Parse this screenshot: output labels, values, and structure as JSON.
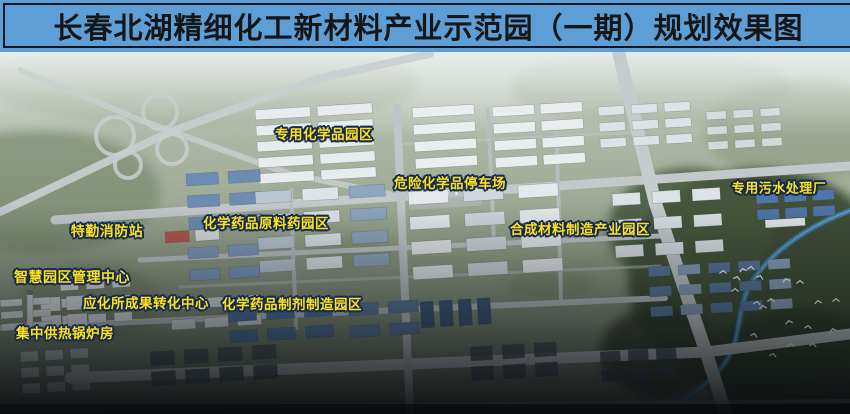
{
  "title": "长春北湖精细化工新材料产业示范园（一期）规划效果图",
  "map": {
    "labels": [
      {
        "id": "special-chemicals-park",
        "text": "专用化学品园区"
      },
      {
        "id": "hazardous-chemicals-parking",
        "text": "危险化学品停车场"
      },
      {
        "id": "dedicated-sewage-plant",
        "text": "专用污水处理厂"
      },
      {
        "id": "api-pharma-park",
        "text": "化学药品原料药园区"
      },
      {
        "id": "special-fire-station",
        "text": "特勤消防站"
      },
      {
        "id": "synthetic-materials-park",
        "text": "合成材料制造产业园区"
      },
      {
        "id": "smart-park-management-center",
        "text": "智慧园区管理中心"
      },
      {
        "id": "ciac-achievement-transfer-center",
        "text": "应化所成果转化中心"
      },
      {
        "id": "pharma-preparation-park",
        "text": "化学药品制剂制造园区"
      },
      {
        "id": "central-heating-boiler-house",
        "text": "集中供热锅炉房"
      }
    ],
    "colors": {
      "title_bar": "#5D9ED6",
      "title_text": "#161616",
      "label_text": "#FFE119",
      "label_outline": "#122A52"
    }
  }
}
